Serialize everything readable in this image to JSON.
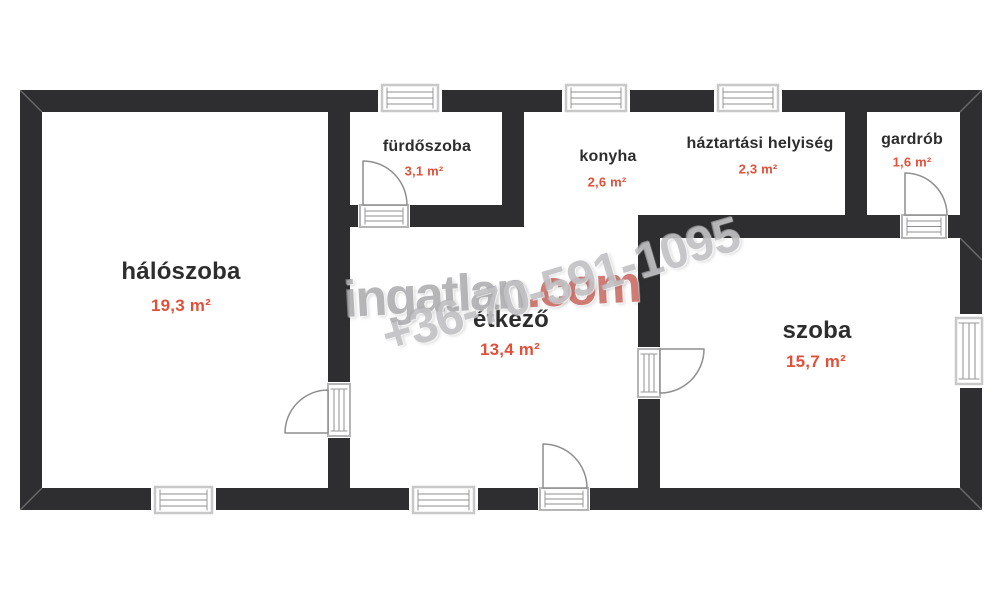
{
  "plan": {
    "title": "floor plan",
    "rooms": [
      {
        "id": "haloszoba",
        "name": "hálószoba",
        "area": "19,3 m²"
      },
      {
        "id": "furdoszoba",
        "name": "fürdőszoba",
        "area": "3,1 m²"
      },
      {
        "id": "konyha",
        "name": "konyha",
        "area": "2,6 m²"
      },
      {
        "id": "haztartasi",
        "name": "háztartási helyiség",
        "area": "2,3 m²"
      },
      {
        "id": "gardrob",
        "name": "gardrób",
        "area": "1,6 m²"
      },
      {
        "id": "etkezo",
        "name": "étkező",
        "area": "13,4 m²"
      },
      {
        "id": "szoba",
        "name": "szoba",
        "area": "15,7 m²"
      }
    ],
    "colors": {
      "wall": "#2e2e30",
      "room_name_text": "#2d2d2d",
      "area_text": "#e2503a",
      "door_window_line": "#8f8f8f",
      "watermark_gray": "#9a9a9e",
      "watermark_red": "#bc3a30"
    }
  },
  "watermark": {
    "brand": "ingatlan",
    "brand_tld": ".com",
    "phone": "+36-70-591-1095"
  }
}
